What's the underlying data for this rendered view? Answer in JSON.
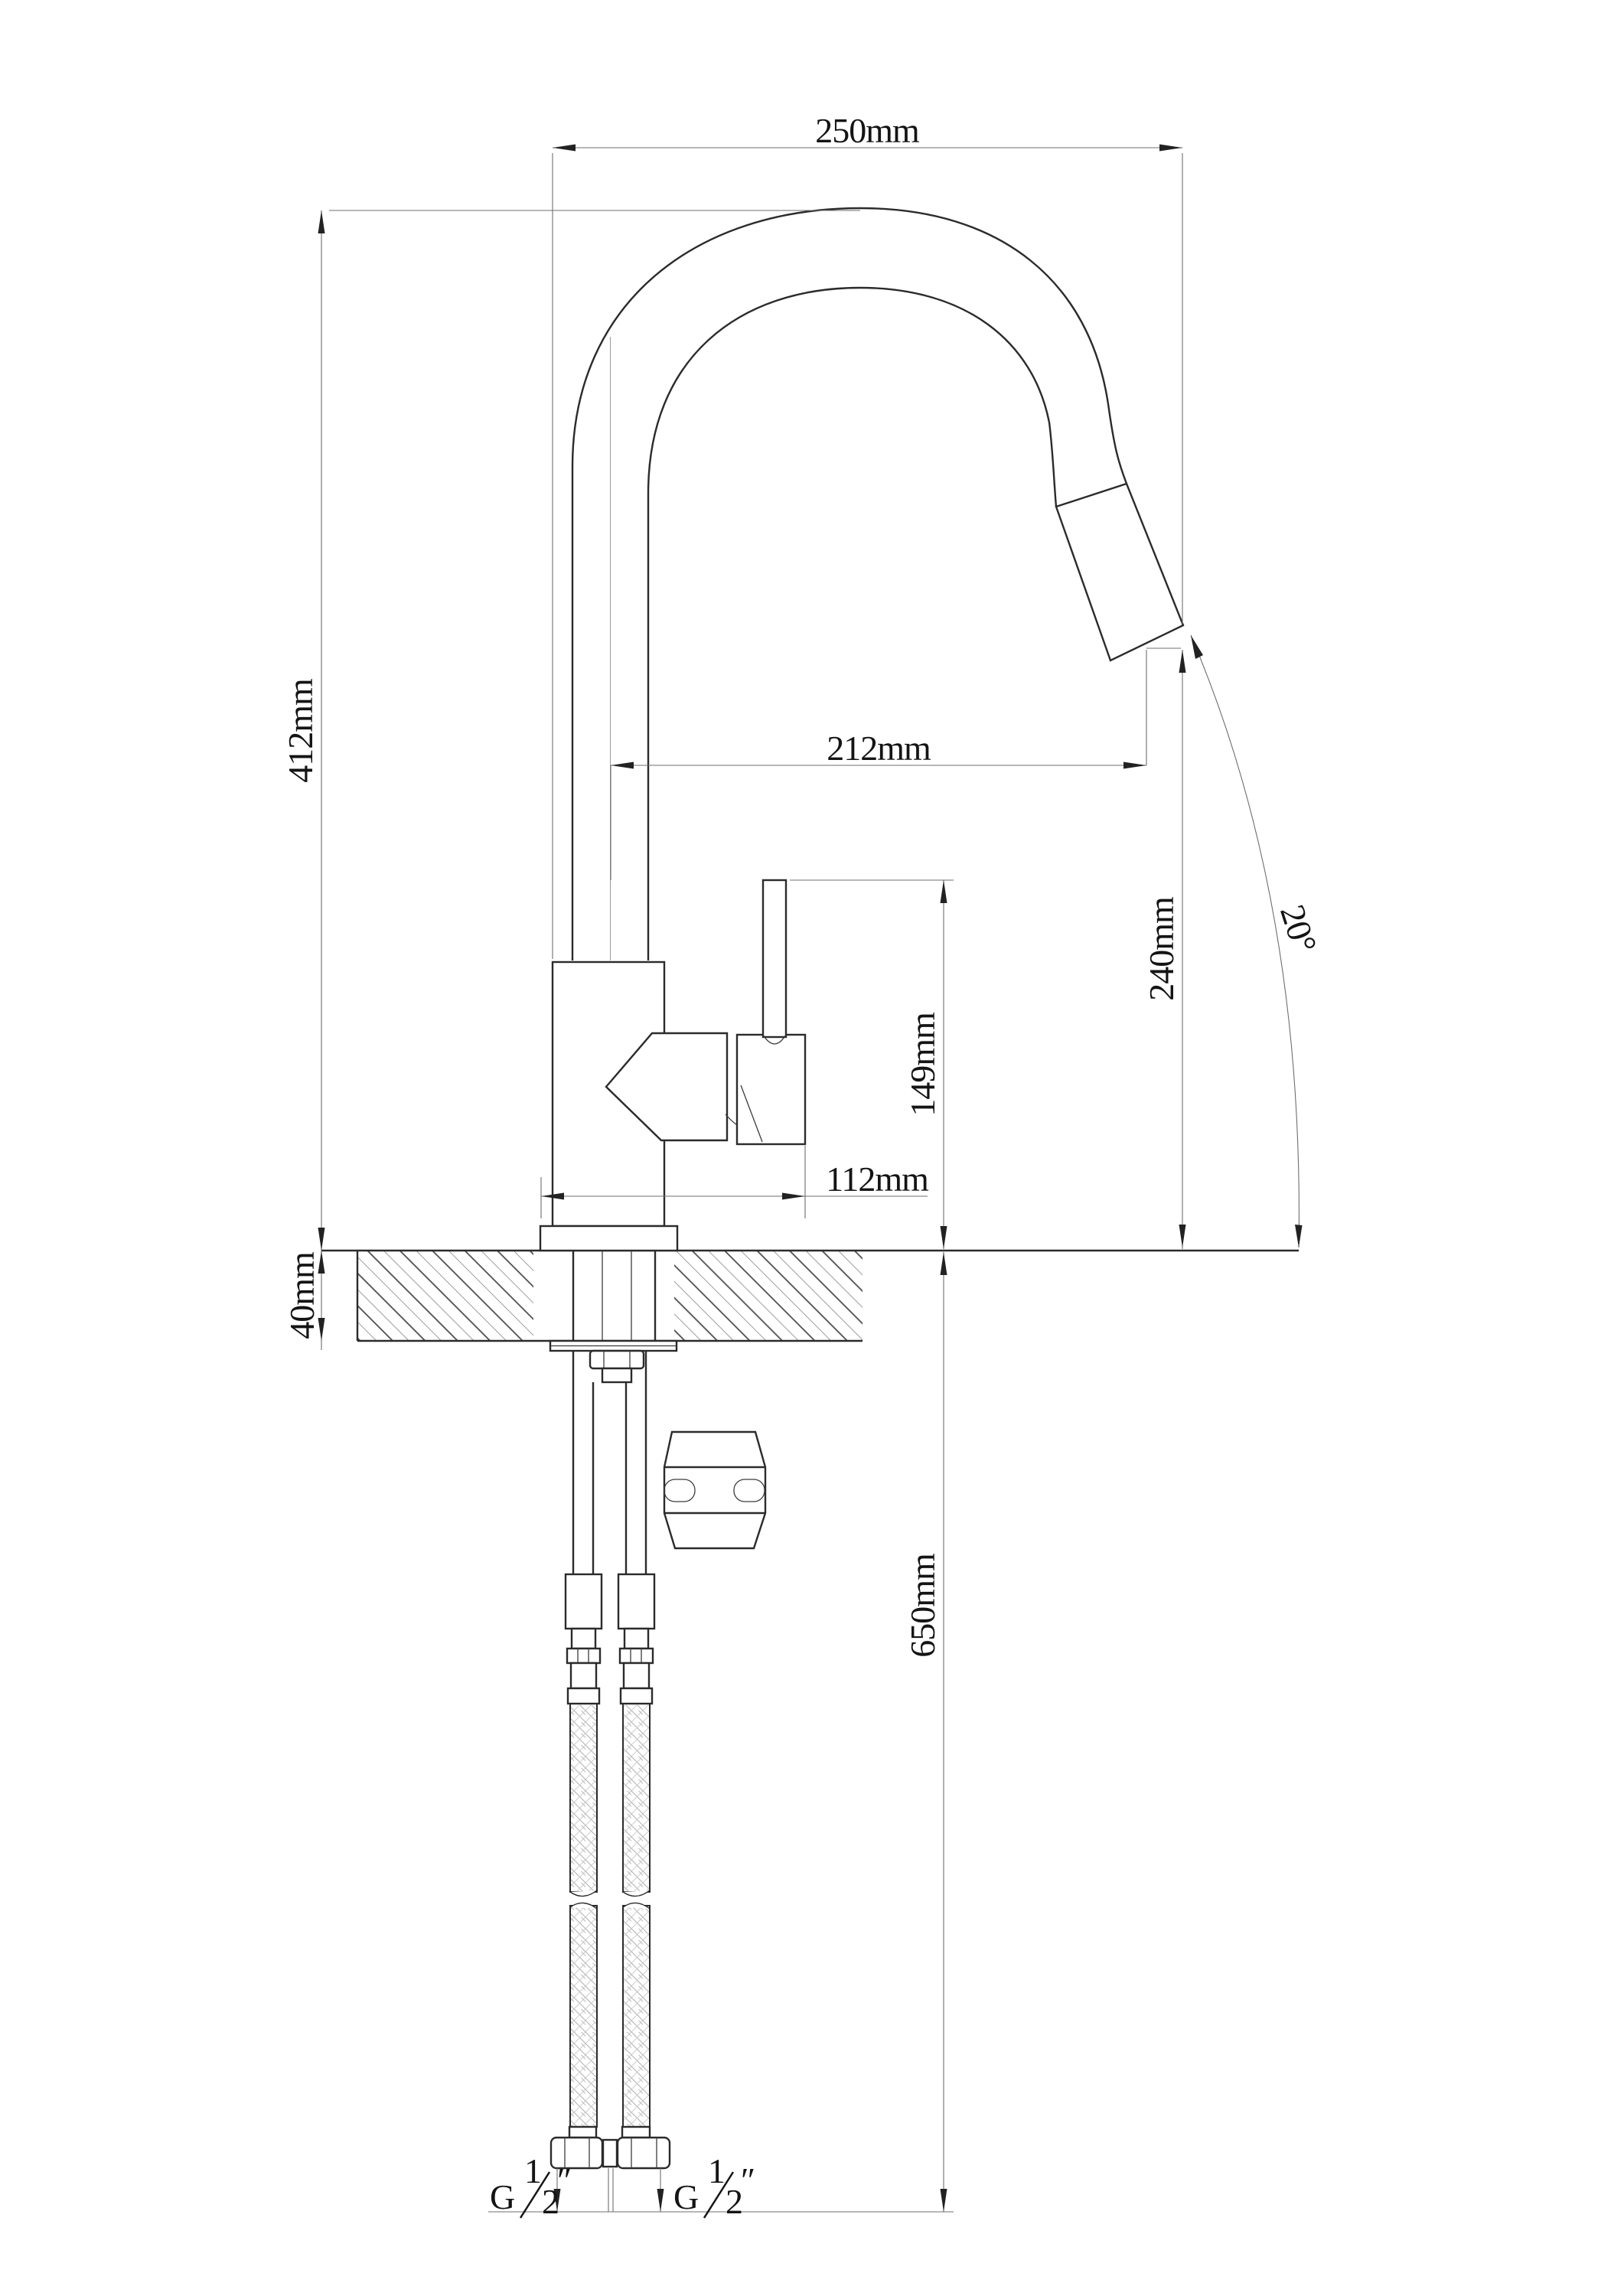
{
  "drawing": {
    "type": "kitchen-faucet-installation-dimension-drawing",
    "units": "mm",
    "background": "#ffffff",
    "line_color": "#2b2b2b",
    "dimension_line_color": "#6f6f6f"
  },
  "dimensions": {
    "spout_reach_overall": {
      "label": "250mm"
    },
    "overall_height": {
      "label": "412mm"
    },
    "outlet_reach": {
      "label": "212mm"
    },
    "outlet_height": {
      "label": "240mm"
    },
    "handle_top_height": {
      "label": "149mm"
    },
    "base_depth": {
      "label": "112mm"
    },
    "deck_thickness": {
      "label": "40mm"
    },
    "hose_length": {
      "label": "650mm"
    },
    "spray_angle": {
      "label": "20°"
    }
  },
  "fittings": {
    "left_hose_thread": {
      "g": "G",
      "numerator": "1",
      "denominator": "2",
      "unit": "″"
    },
    "right_hose_thread": {
      "g": "G",
      "numerator": "1",
      "denominator": "2",
      "unit": "″"
    }
  }
}
